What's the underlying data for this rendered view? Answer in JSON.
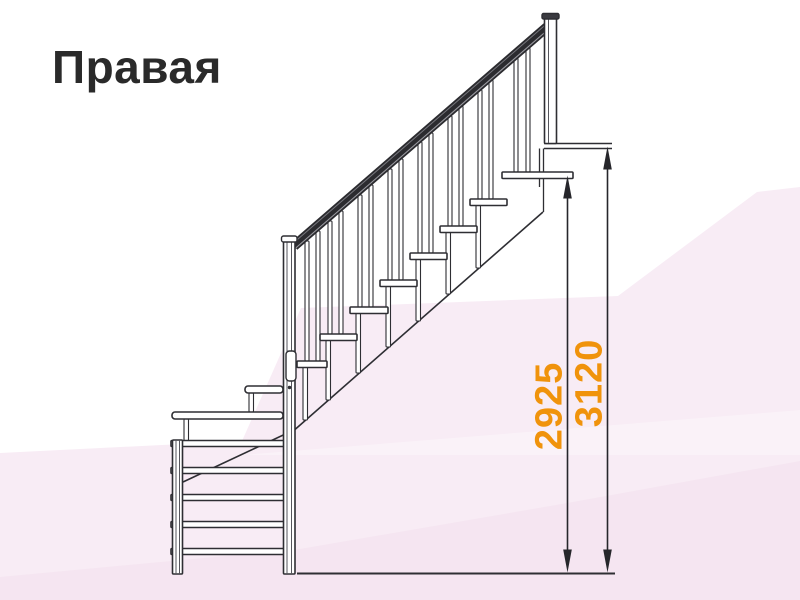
{
  "title": {
    "text": "Правая"
  },
  "colors": {
    "title": "#2a2a2a",
    "line": "#2e2e33",
    "thin": "#55555c",
    "rail": "#2b2b2f",
    "rail_hi1": "#9a9aa0",
    "rail_hi2": "#77777d",
    "dim": "#26262b",
    "accent_orange": "#f0930c",
    "white": "#ffffff",
    "pink1": "#f8ecf5",
    "pink2": "#f2e0ec",
    "cap_dark": "#3a3a40"
  },
  "background_facets": [
    {
      "name": "bg-facet-main",
      "points": "0,453 242,441 301,308 618,296 757,192 800,187 800,600 0,600",
      "fill": "pink1",
      "opacity": 1
    },
    {
      "name": "bg-facet-bottom",
      "points": "0,577 300,549 556,505 800,461 800,600 0,600",
      "fill": "pink2",
      "opacity": 0.55
    },
    {
      "name": "bg-facet-highlight",
      "points": "242,455 800,410 800,455",
      "fill": "white",
      "opacity": 0.3
    }
  ],
  "drawing": {
    "lines": [
      {
        "name": "upper-floor-line-top",
        "x1": 544,
        "y1": 143.5,
        "x2": 612,
        "y2": 143.5,
        "w": 1.6,
        "stroke": "line"
      },
      {
        "name": "upper-floor-line-bottom",
        "x1": 544,
        "y1": 148.5,
        "x2": 612,
        "y2": 148.5,
        "w": 1.6,
        "stroke": "line"
      },
      {
        "name": "landing-riser-line-a",
        "x1": 539.5,
        "y1": 148.5,
        "x2": 539.5,
        "y2": 187,
        "w": 1.3,
        "stroke": "line"
      },
      {
        "name": "landing-riser-line-b",
        "x1": 543.5,
        "y1": 148.5,
        "x2": 543.5,
        "y2": 212,
        "w": 1.3,
        "stroke": "line"
      },
      {
        "name": "stringer-lower-flight",
        "x1": 183,
        "y1": 482,
        "x2": 295,
        "y2": 429.5,
        "w": 1.6,
        "stroke": "line"
      },
      {
        "name": "stringer-upper-flight",
        "x1": 295,
        "y1": 429.5,
        "x2": 543,
        "y2": 212,
        "w": 1.6,
        "stroke": "line"
      }
    ],
    "rail": [
      {
        "name": "handrail",
        "x1": 294,
        "y1": 246,
        "x2": 547,
        "y2": 27,
        "w": 10,
        "stroke": "rail"
      },
      {
        "name": "handrail-stripe-lower",
        "x1": 294,
        "y1": 249.5,
        "x2": 547,
        "y2": 30.5,
        "w": 1.1,
        "stroke": "rail_hi1"
      },
      {
        "name": "handrail-stripe-upper",
        "x1": 294,
        "y1": 242.5,
        "x2": 547,
        "y2": 23.5,
        "w": 1.0,
        "stroke": "rail_hi2"
      }
    ],
    "supports": [
      {
        "name": "tread-support",
        "x": 303,
        "y1": 367,
        "y2": 420
      },
      {
        "name": "tread-support",
        "x": 326,
        "y1": 340.5,
        "y2": 400
      },
      {
        "name": "tread-support",
        "x": 356,
        "y1": 313.5,
        "y2": 373
      },
      {
        "name": "tread-support",
        "x": 386,
        "y1": 286.5,
        "y2": 347
      },
      {
        "name": "tread-support",
        "x": 416,
        "y1": 259.5,
        "y2": 321
      },
      {
        "name": "tread-support",
        "x": 446,
        "y1": 232.5,
        "y2": 294
      },
      {
        "name": "tread-support",
        "x": 476,
        "y1": 205.5,
        "y2": 268
      },
      {
        "name": "winder-support",
        "x": 249,
        "y1": 393,
        "y2": 412
      },
      {
        "name": "winder-support",
        "x": 184,
        "y1": 419,
        "y2": 440.5
      }
    ],
    "balusters": [
      {
        "x": 305,
        "y1": 241,
        "y2": 361
      },
      {
        "x": 316,
        "y1": 231,
        "y2": 361
      },
      {
        "x": 328,
        "y1": 221,
        "y2": 334
      },
      {
        "x": 339,
        "y1": 211,
        "y2": 334
      },
      {
        "x": 358,
        "y1": 195,
        "y2": 307
      },
      {
        "x": 369,
        "y1": 185,
        "y2": 307
      },
      {
        "x": 388,
        "y1": 169,
        "y2": 280
      },
      {
        "x": 399,
        "y1": 159,
        "y2": 280
      },
      {
        "x": 418,
        "y1": 142,
        "y2": 253
      },
      {
        "x": 429,
        "y1": 133,
        "y2": 253
      },
      {
        "x": 448,
        "y1": 116,
        "y2": 226
      },
      {
        "x": 459,
        "y1": 106,
        "y2": 226
      },
      {
        "x": 478,
        "y1": 90,
        "y2": 199
      },
      {
        "x": 489,
        "y1": 80,
        "y2": 199
      },
      {
        "x": 514,
        "y1": 58,
        "y2": 172
      },
      {
        "x": 526,
        "y1": 48,
        "y2": 172
      }
    ],
    "treads": [
      {
        "name": "tread-1",
        "x": 297,
        "y": 361,
        "w": 30,
        "h": 6.5
      },
      {
        "name": "tread-2",
        "x": 320,
        "y": 334,
        "w": 37,
        "h": 6.5
      },
      {
        "name": "tread-3",
        "x": 350,
        "y": 307,
        "w": 38,
        "h": 6.5
      },
      {
        "name": "tread-4",
        "x": 380,
        "y": 280,
        "w": 37,
        "h": 6.5
      },
      {
        "name": "tread-5",
        "x": 410,
        "y": 253,
        "w": 37,
        "h": 6.5
      },
      {
        "name": "tread-6",
        "x": 440,
        "y": 226,
        "w": 37,
        "h": 6.5
      },
      {
        "name": "tread-7",
        "x": 470,
        "y": 199,
        "w": 37,
        "h": 6.5
      },
      {
        "name": "tread-top-landing",
        "x": 502,
        "y": 172,
        "w": 71,
        "h": 6.5
      },
      {
        "name": "winder-tread-upper",
        "x": 245,
        "y": 386,
        "w": 38,
        "h": 7,
        "rx": 3
      },
      {
        "name": "winder-tread-wide",
        "x": 172,
        "y": 412,
        "w": 111,
        "h": 7,
        "rx": 3
      }
    ],
    "lower_bars": [
      {
        "name": "lower-flight-tread-edge",
        "x": 171,
        "y": 440.5,
        "w": 119,
        "h": 6
      },
      {
        "name": "lower-flight-tread-edge",
        "x": 171,
        "y": 467.5,
        "w": 119,
        "h": 6
      },
      {
        "name": "lower-flight-tread-edge",
        "x": 171,
        "y": 494.5,
        "w": 119,
        "h": 6
      },
      {
        "name": "lower-flight-tread-edge",
        "x": 171,
        "y": 521.5,
        "w": 119,
        "h": 6
      },
      {
        "name": "lower-flight-tread-edge",
        "x": 171,
        "y": 548.5,
        "w": 119,
        "h": 6
      }
    ],
    "posts": [
      {
        "name": "newel-post-middle",
        "x": 283.5,
        "y": 237,
        "w": 11.5,
        "h": 337
      },
      {
        "name": "newel-post-lower-left",
        "x": 172.5,
        "y": 440,
        "w": 10,
        "h": 134
      },
      {
        "name": "newel-post-top",
        "x": 544.5,
        "y": 17,
        "w": 12,
        "h": 126.5
      }
    ],
    "post_inner_lines": [
      {
        "x": 287,
        "y1": 237,
        "y2": 574
      },
      {
        "x": 291.5,
        "y1": 237,
        "y2": 574
      },
      {
        "x": 176,
        "y1": 440,
        "y2": 574
      },
      {
        "x": 179.5,
        "y1": 440,
        "y2": 574
      },
      {
        "x": 548.5,
        "y1": 17,
        "y2": 143
      }
    ],
    "caps": [
      {
        "name": "post-cap-middle",
        "x": 281.5,
        "y": 236,
        "w": 15.5,
        "h": 6,
        "rx": 2,
        "fill": "white"
      },
      {
        "name": "post-cap-top",
        "x": 542,
        "y": 13.5,
        "w": 17,
        "h": 5.5,
        "rx": 1.5,
        "fill": "cap_dark"
      },
      {
        "name": "post-bracket",
        "x": 286,
        "y": 351,
        "w": 10,
        "h": 30,
        "rx": 3.5,
        "fill": "white"
      }
    ],
    "bolt": {
      "name": "bolt-dot",
      "cx": 289.5,
      "cy": 387.5,
      "r": 1.7
    },
    "ground_line": {
      "name": "ground-line",
      "x1": 297,
      "y1": 573.5,
      "x2": 615,
      "y2": 573.5,
      "w": 2,
      "stroke": "line"
    }
  },
  "dimensions": [
    {
      "label": "2925",
      "x": 567.5,
      "tip_top": 175.5,
      "tip_bottom": 572.5,
      "label_x": 561.5,
      "label_y": 406
    },
    {
      "label": "3120",
      "x": 607.5,
      "tip_top": 146.5,
      "tip_bottom": 572.5,
      "label_x": 601.5,
      "label_y": 383
    }
  ]
}
